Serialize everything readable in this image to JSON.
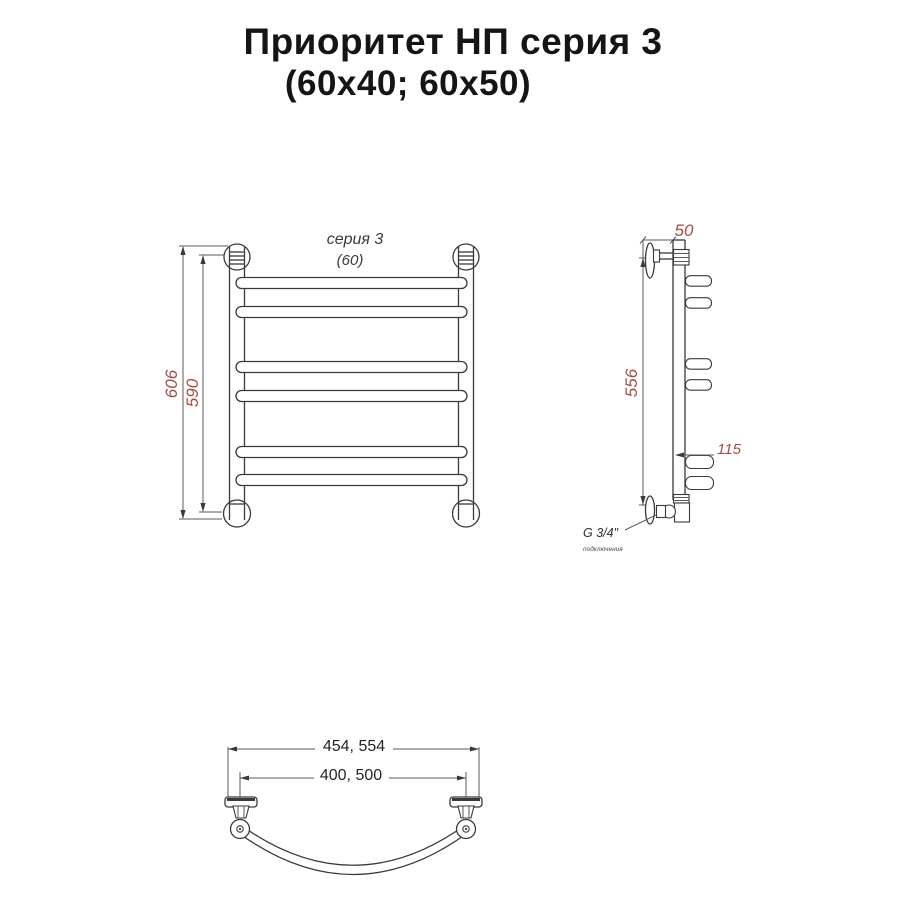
{
  "title": {
    "line1": "Приоритет НП серия 3",
    "line2": "(60x40; 60x50)"
  },
  "front_view": {
    "series_label": "серия 3",
    "width_label": "(60)",
    "overall_height": "606",
    "mount_height": "590"
  },
  "side_view": {
    "depth": "50",
    "height": "556",
    "bottom_rung_length": "115",
    "thread": "G 3/4\"",
    "thread_note": "подключения"
  },
  "bottom_view": {
    "outer_width": "454, 554",
    "mount_width": "400, 500"
  },
  "colors": {
    "dim_accent": "#a84b3e",
    "line": "#3a3a3a",
    "title_text": "#151515"
  }
}
